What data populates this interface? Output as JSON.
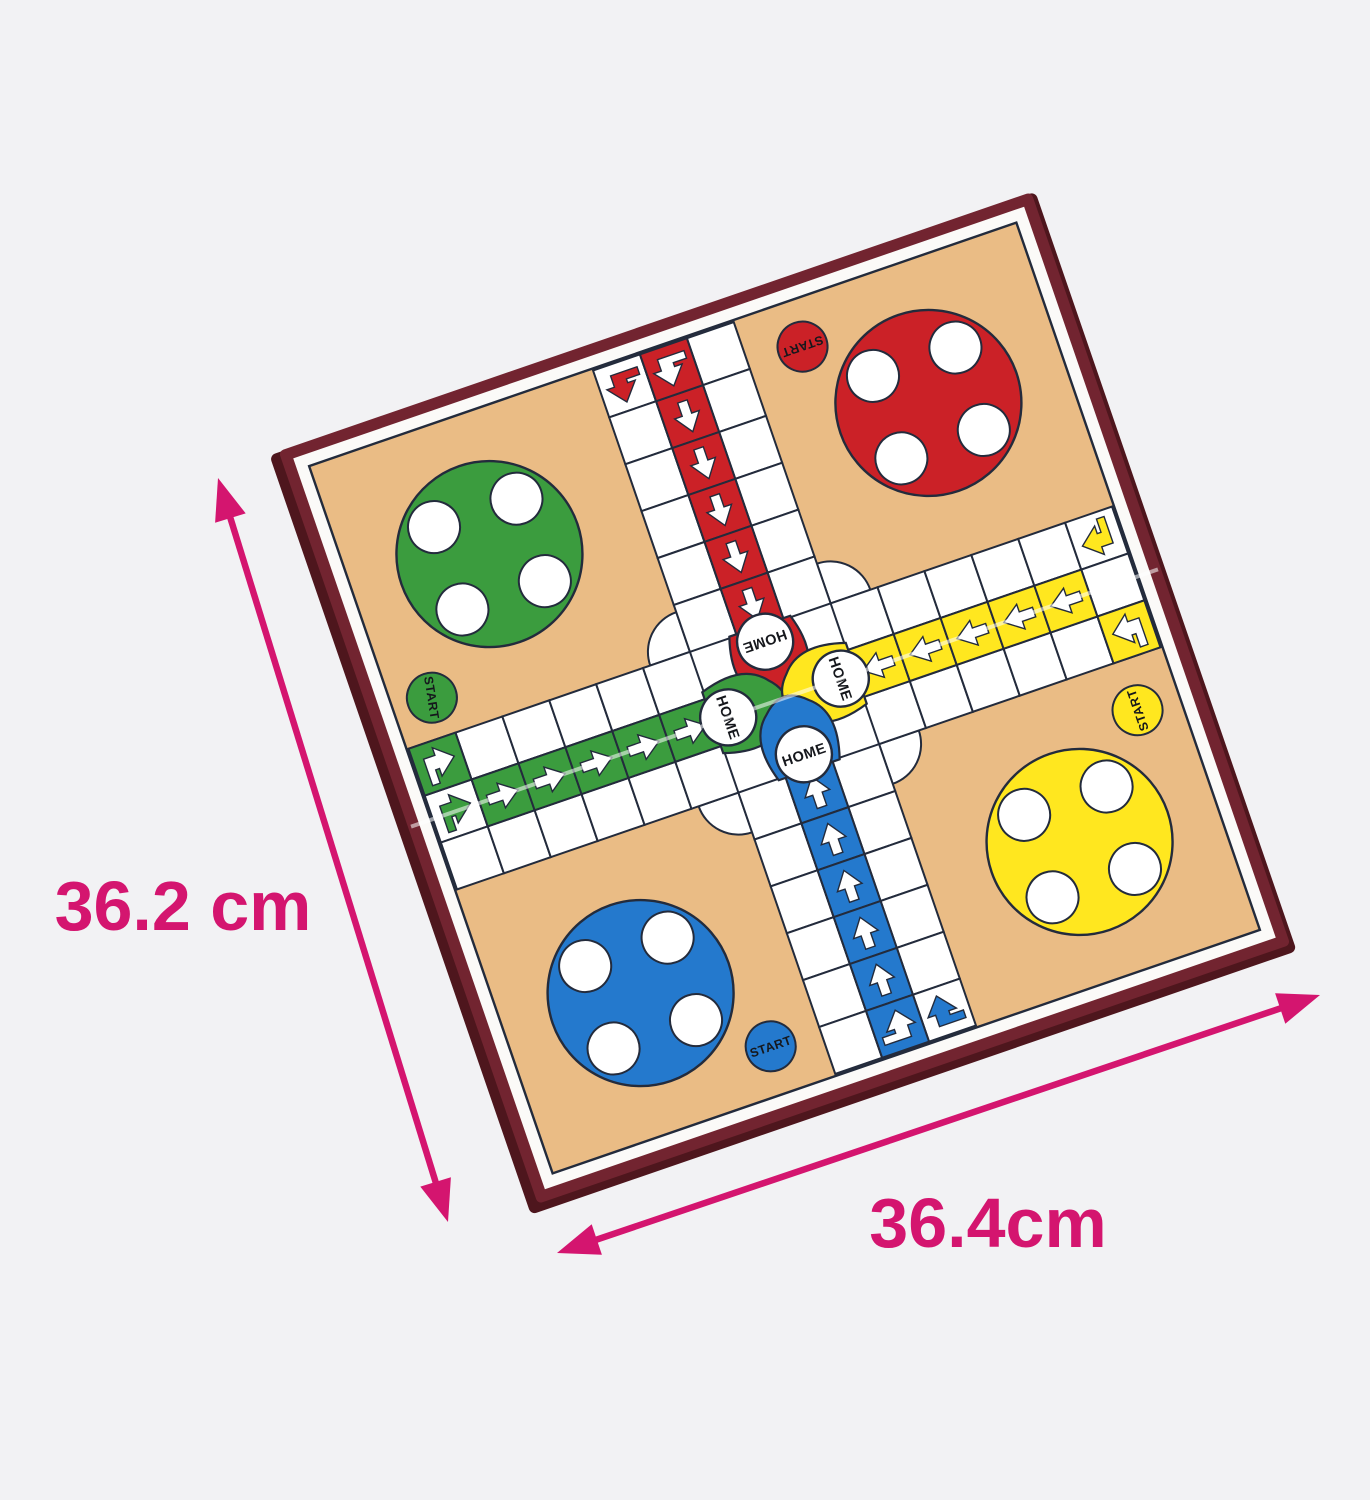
{
  "scene": {
    "background": "#f2f2f4",
    "width": 1370,
    "height": 1500,
    "description": "Folding Ludo game board product photo, tilted, with size annotations"
  },
  "dimensions": {
    "height_label": "36.2 cm",
    "width_label": "36.4cm",
    "color": "#d4156f"
  },
  "board": {
    "rotation_deg": -19,
    "frame_color": "#722430",
    "frame_edge_color": "#4e161d",
    "margin_color": "#fbfaf8",
    "field_color": "#eabc85",
    "line_color": "#232b3c",
    "track_color": "#ffffff",
    "fold_crease_color": "rgba(255,255,255,0.55)",
    "labels": {
      "home": "HOME",
      "start": "START"
    },
    "players": [
      {
        "id": "red",
        "color": "#cb2127"
      },
      {
        "id": "green",
        "color": "#3b9c3e"
      },
      {
        "id": "yellow",
        "color": "#ffe71f"
      },
      {
        "id": "blue",
        "color": "#2479cd"
      }
    ],
    "icons": {
      "path_arrow": "straight directional arrow marking home path cells",
      "entry_arrow": "bent arrow marking track entry cells"
    }
  }
}
